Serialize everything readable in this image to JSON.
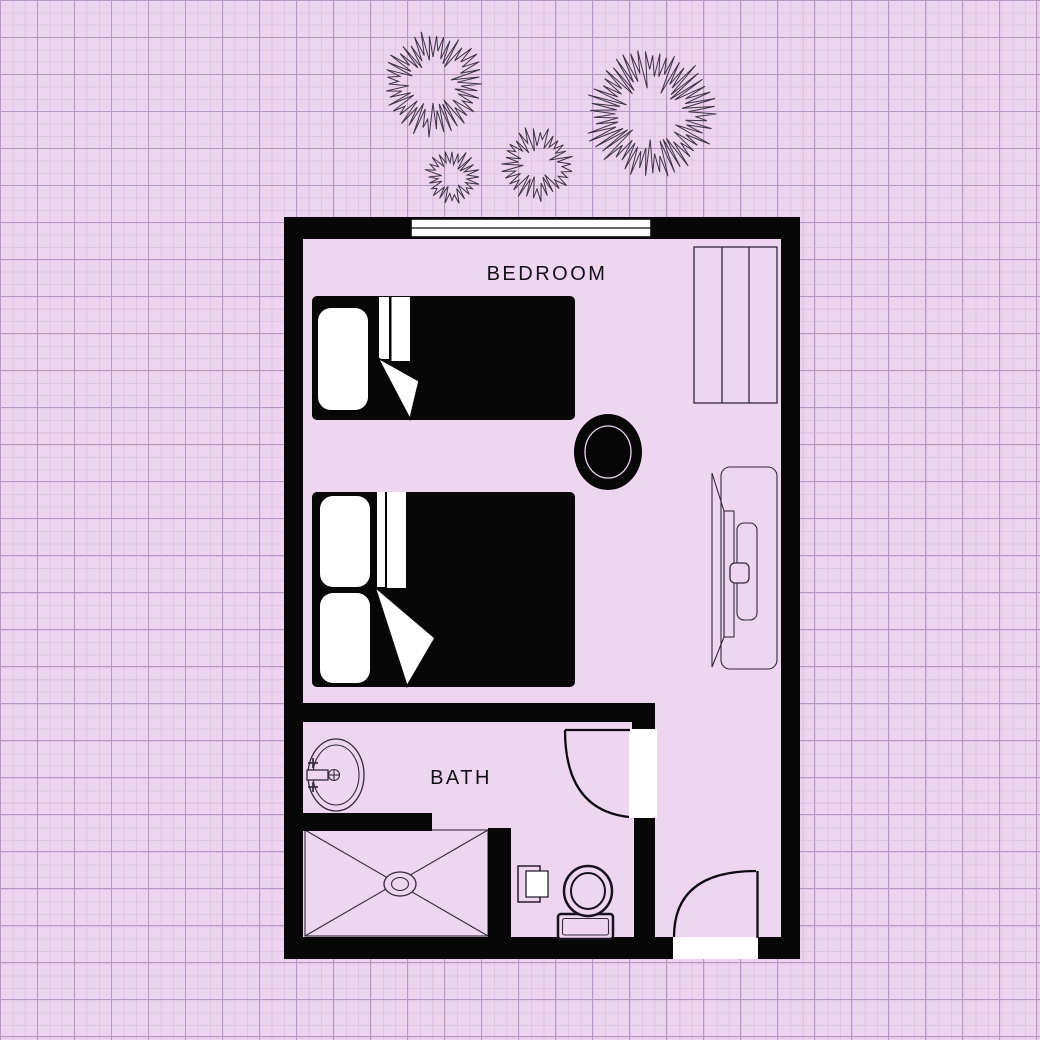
{
  "plan": {
    "type": "floor-plan",
    "labels": {
      "bedroom": "BEDROOM",
      "bath": "BATH"
    },
    "colors": {
      "background": "#ecd3ee",
      "grid_minor": "#e0c3e6",
      "grid_major": "#b697c1",
      "wall": "#070707",
      "floor": "#eed5f0",
      "furniture_line": "#332b3a",
      "bed_fill": "#070707",
      "accent_white": "#ffffff"
    },
    "rooms": [
      {
        "name": "BEDROOM"
      },
      {
        "name": "BATH"
      }
    ],
    "furniture": [
      "window",
      "wardrobe",
      "single-bed",
      "double-bed",
      "side-table",
      "tv-stand",
      "bath-door",
      "sink",
      "shower",
      "toilet",
      "towel-holder",
      "entrance-door"
    ],
    "plants": [
      {
        "cx": 433,
        "cy": 84,
        "r": 53,
        "seed": 7
      },
      {
        "cx": 452,
        "cy": 177,
        "r": 28,
        "seed": 13
      },
      {
        "cx": 537,
        "cy": 164,
        "r": 38,
        "seed": 29
      },
      {
        "cx": 651,
        "cy": 114,
        "r": 66,
        "seed": 41
      }
    ]
  }
}
